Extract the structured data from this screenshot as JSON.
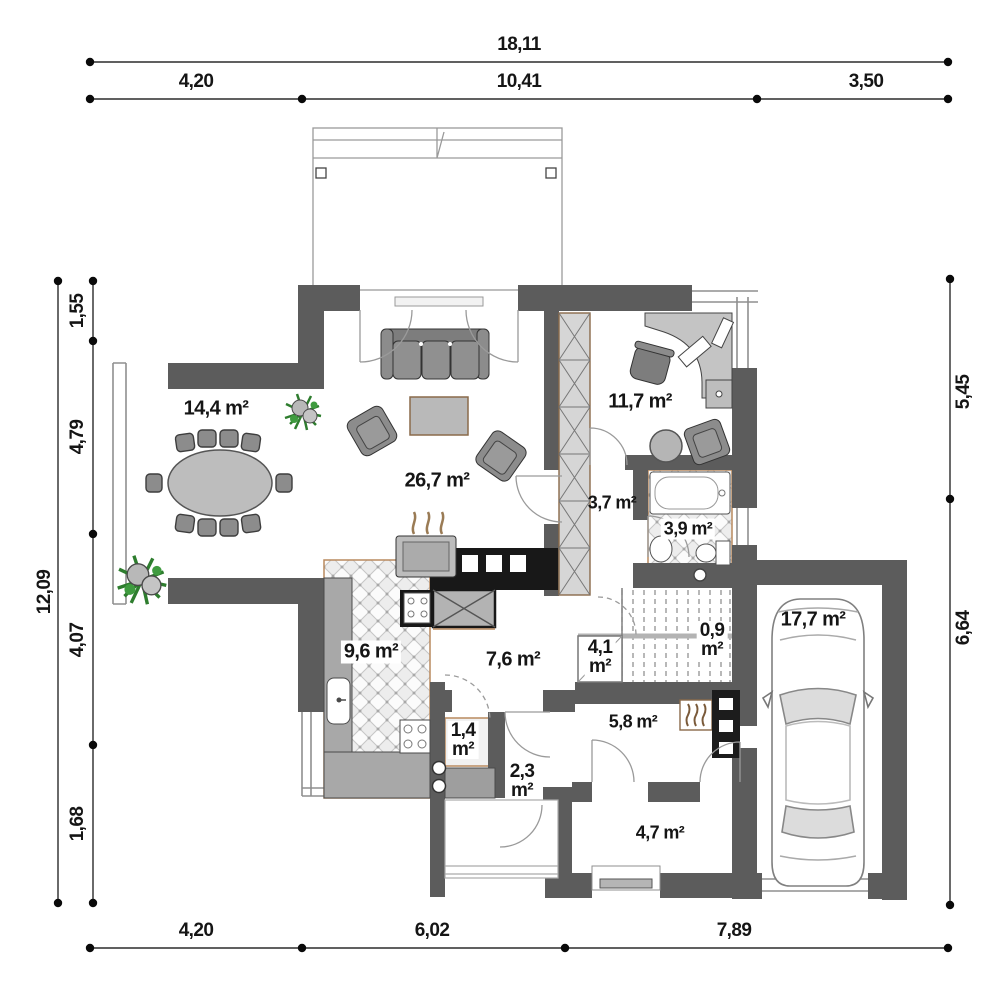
{
  "dims": {
    "top_total": "18,11",
    "top": [
      "4,20",
      "10,41",
      "3,50"
    ],
    "left_total": "12,09",
    "left": [
      "1,55",
      "4,79",
      "4,07",
      "1,68"
    ],
    "right": [
      "5,45",
      "6,64"
    ],
    "bottom": [
      "4,20",
      "6,02",
      "7,89"
    ]
  },
  "rooms": {
    "dining": "14,4 m²",
    "living": "26,7 m²",
    "office": "11,7 m²",
    "corridor": "3,7 m²",
    "bathroom": "3,9 m²",
    "kitchen": "9,6 m²",
    "hall": "7,6 m²",
    "utility": "5,8 m²",
    "entry": "4,7 m²",
    "garage": "17,7 m²",
    "understairs": {
      "v": "4,1",
      "u": "m²"
    },
    "landing": {
      "v": "0,9",
      "u": "m²"
    },
    "pantry": {
      "v": "1,4",
      "u": "m²"
    },
    "vestibule": {
      "v": "2,3",
      "u": "m²"
    }
  },
  "colors": {
    "wall": "#5c5c5c",
    "furniture": "#8c8c8c",
    "wood_trim": "#b98a5f",
    "plant_green": "#2e7d2e",
    "appliance_black": "#181818"
  }
}
